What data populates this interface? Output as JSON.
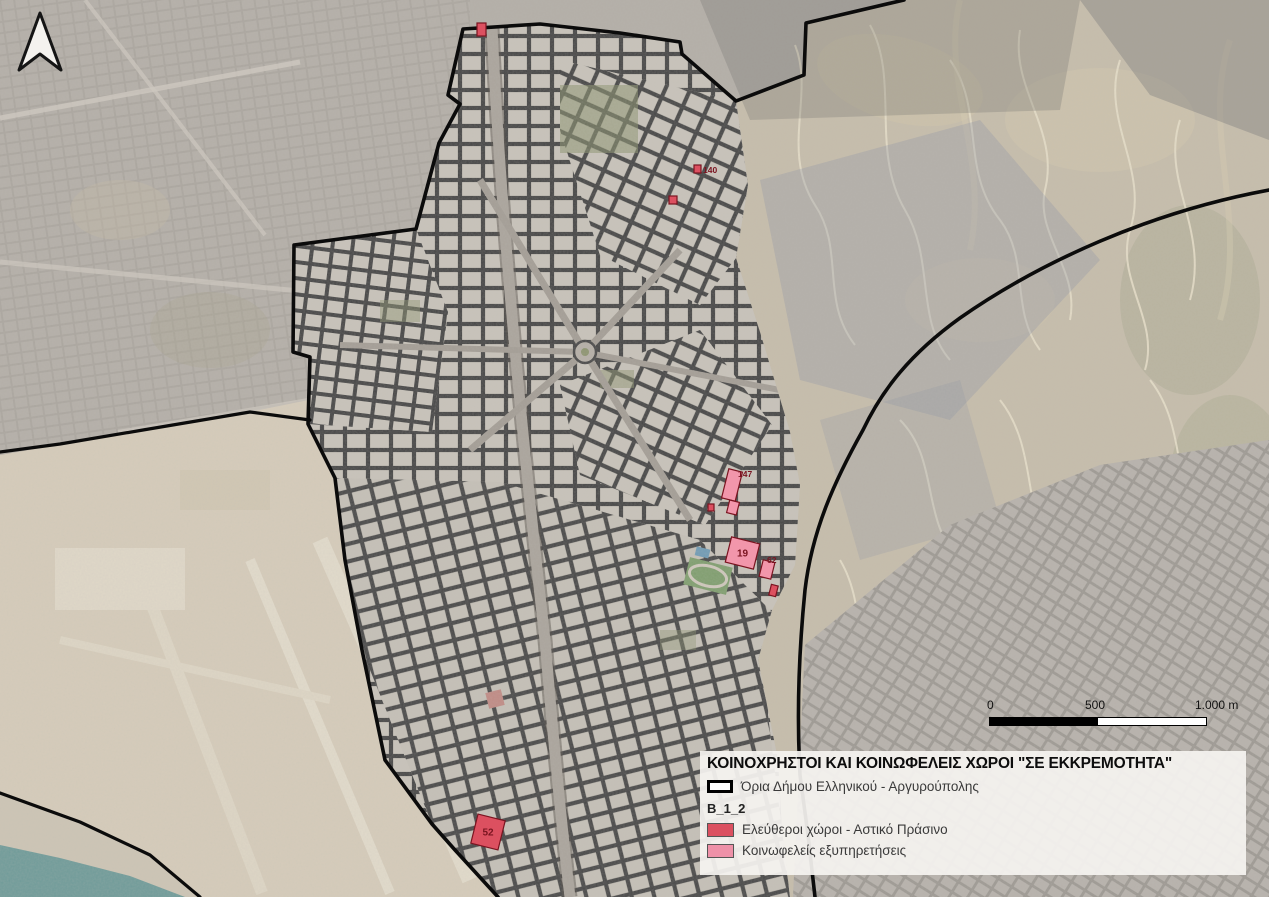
{
  "legend": {
    "title": "ΚΟΙΝΟΧΡΗΣΤΟΙ ΚΑΙ ΚΟΙΝΩΦΕΛΕΙΣ ΧΩΡΟΙ \"ΣΕ ΕΚΚΡΕΜΟΤΗΤΑ\"",
    "boundary_label": "Όρια Δήμου Ελληνικού - Αργυρούπολης",
    "group_label": "B_1_2",
    "items": [
      {
        "label": "Ελεύθεροι χώροι - Αστικό Πράσινο",
        "color": "#db5060"
      },
      {
        "label": "Κοινωφελείς εξυπηρετήσεις",
        "color": "#ee91a8"
      }
    ]
  },
  "scalebar": {
    "tick0": "0",
    "tick500": "500",
    "tick1000": "1.000 m"
  },
  "map": {
    "parcel_colors": {
      "red": "#dc5060",
      "pink": "#f296ab",
      "stroke": "#7a1420",
      "label": "#7a1420"
    },
    "parcels": [
      {
        "label": "",
        "type": "red",
        "x": 477,
        "y": 23,
        "w": 9,
        "h": 13,
        "rot": 0,
        "inside": false
      },
      {
        "label": "140",
        "type": "red",
        "x": 694,
        "y": 165,
        "w": 7,
        "h": 8,
        "rot": 0,
        "inside": false,
        "lx": 703,
        "ly": 173
      },
      {
        "label": "",
        "type": "red",
        "x": 669,
        "y": 196,
        "w": 8,
        "h": 8,
        "rot": 0,
        "inside": false
      },
      {
        "label": "147",
        "type": "pink",
        "x": 725,
        "y": 470,
        "w": 14,
        "h": 30,
        "rot": 14,
        "inside": false,
        "lx": 738,
        "ly": 477
      },
      {
        "label": "",
        "type": "pink",
        "x": 728,
        "y": 501,
        "w": 10,
        "h": 13,
        "rot": 14,
        "inside": false
      },
      {
        "label": "",
        "type": "red",
        "x": 708,
        "y": 504,
        "w": 6,
        "h": 7,
        "rot": 0,
        "inside": false
      },
      {
        "label": "19",
        "type": "pink",
        "x": 728,
        "y": 540,
        "w": 29,
        "h": 26,
        "rot": 14,
        "inside": true
      },
      {
        "label": "62",
        "type": "pink",
        "x": 761,
        "y": 561,
        "w": 12,
        "h": 17,
        "rot": 14,
        "inside": false,
        "lx": 767,
        "ly": 563
      },
      {
        "label": "",
        "type": "red",
        "x": 770,
        "y": 585,
        "w": 7,
        "h": 11,
        "rot": 14,
        "inside": false
      },
      {
        "label": "52",
        "type": "red",
        "x": 474,
        "y": 817,
        "w": 28,
        "h": 30,
        "rot": 14,
        "inside": true
      }
    ]
  }
}
